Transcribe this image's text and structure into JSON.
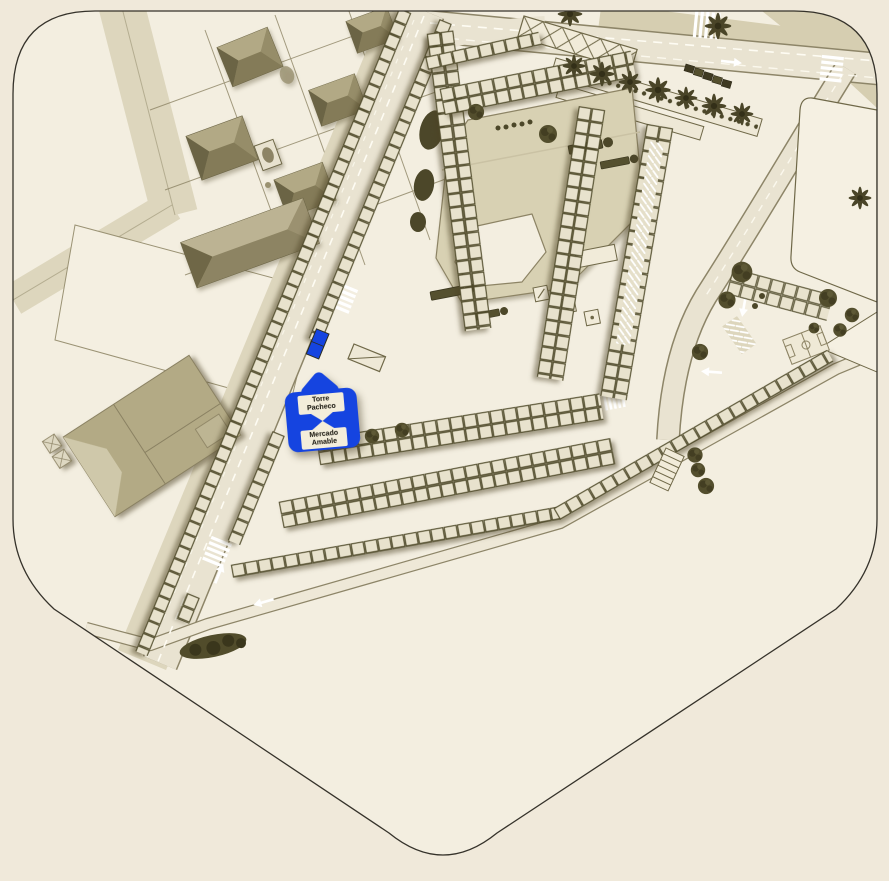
{
  "marker": {
    "primary": "Torre Pacheco",
    "secondary": "Mercado Amable"
  },
  "colors": {
    "background": "#f0e9da",
    "ground": "#f3eee0",
    "boundary_line": "#35322a",
    "road_fill": "#e9e3d1",
    "road_edge": "#8d8568",
    "sidewalk": "#ddd6bd",
    "stall_fill": "#e8e2cd",
    "stall_stroke": "#514c2c",
    "building_khaki": "#b3aa85",
    "roof_dark": "#6b6445",
    "roof_light": "#b2a985",
    "plaza_fill": "#d8d1b3",
    "vegetation": "#4c4729",
    "lane_marking": "#fffdf4",
    "marker_blue": "#1544e0",
    "marker_label_bg": "#f3edda",
    "marker_text": "#16140c"
  }
}
